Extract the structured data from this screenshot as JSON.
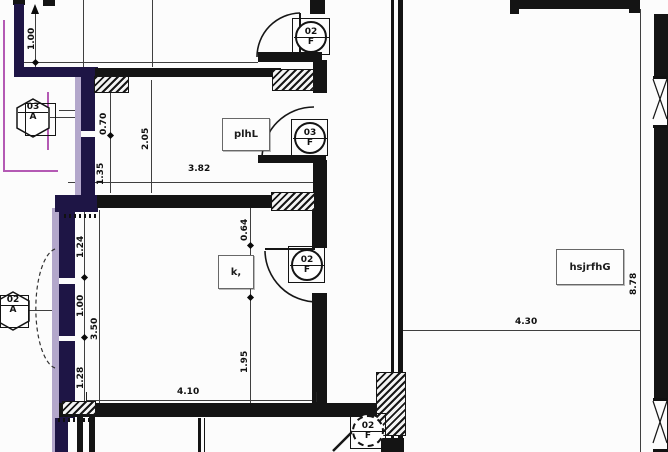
{
  "drawing": {
    "room_labels": {
      "hall": "plhL",
      "kitchen": "k,",
      "main_room": "hsjrfhG"
    },
    "dimensions": {
      "top_left_v": "1.00",
      "upper_a": "0.70",
      "upper_b": "1.35",
      "upper_total": "2.05",
      "upper_width": "3.82",
      "mid_a": "0.64",
      "mid_b": "0.80",
      "mid_c": "1.95",
      "left_a": "1.24",
      "left_b": "1.00",
      "left_c": "1.28",
      "left_total": "3.50",
      "bottom_width": "4.10",
      "main_width": "4.30",
      "main_height": "8.78"
    },
    "tags": {
      "door_top": {
        "num": "02",
        "letter": "F"
      },
      "door_hall": {
        "num": "03",
        "letter": "F"
      },
      "door_mid": {
        "num": "02",
        "letter": "F"
      },
      "door_bottom": {
        "num": "02",
        "letter": "F"
      },
      "window_upper": {
        "num": "03",
        "letter": "A"
      },
      "window_lower": {
        "num": "02",
        "letter": "A"
      }
    },
    "colors": {
      "wall": "#141414",
      "navy_wall": "#1e1545",
      "lavender": "#b3a7cb",
      "magenta": "#b45ab4"
    }
  }
}
